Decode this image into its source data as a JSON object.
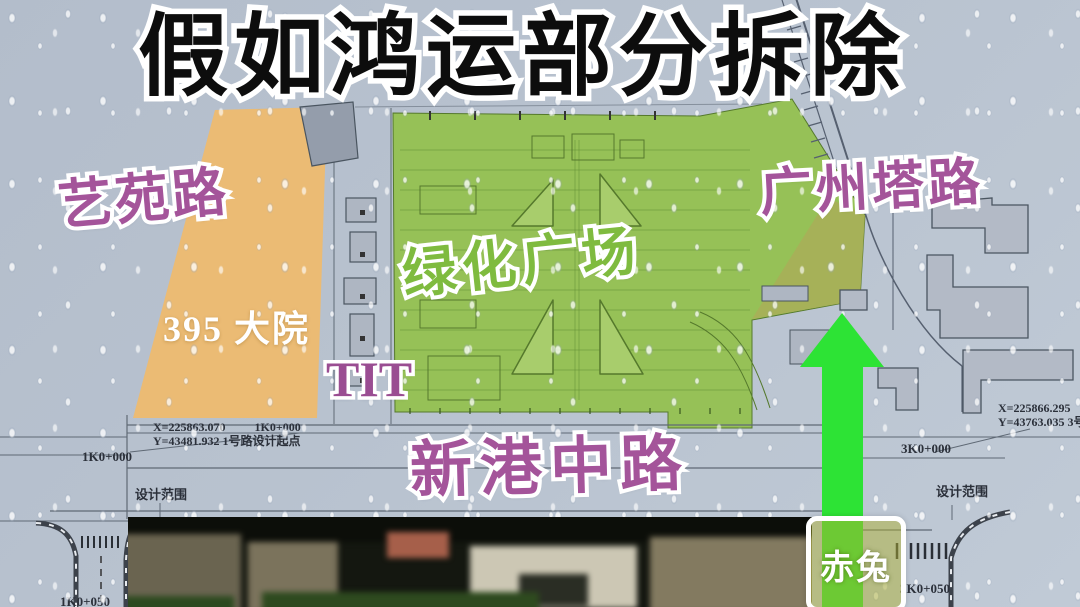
{
  "title": "假如鸿运部分拆除",
  "overlay_labels": {
    "yiyuan_road": "艺苑路",
    "compound_395": "395 大院",
    "tit": "TIT",
    "green_plaza": "绿化广场",
    "guangzhou_tower_road": "广州塔路",
    "xingang_middle_road": "新港中路",
    "arrow_badge": "赤兔"
  },
  "cad_annotations": {
    "start_x": "X=225863.070",
    "start_station": "1K0+000",
    "start_y": "Y=43481.932 1号路设计起点",
    "left_station": "1K0+000",
    "left_station_2": "1K0+050",
    "design_scope_left": "设计范围",
    "design_scope_right": "设计范围",
    "right_station": "3K0+000",
    "right_station_2": "3K0+050",
    "end_x": "X=225866.295",
    "end_y": "Y=43763.035 3号"
  },
  "colors": {
    "background": "#b6c0cd",
    "plaza_green": "#94c150",
    "plaza_olive": "#a9ae58",
    "parcel_orange": "#edba70",
    "road_label_purple": "#a4549a",
    "plaza_label_green": "#7fbb3f",
    "arrow_green": "#2de335",
    "title_black": "#0d0d0d"
  }
}
